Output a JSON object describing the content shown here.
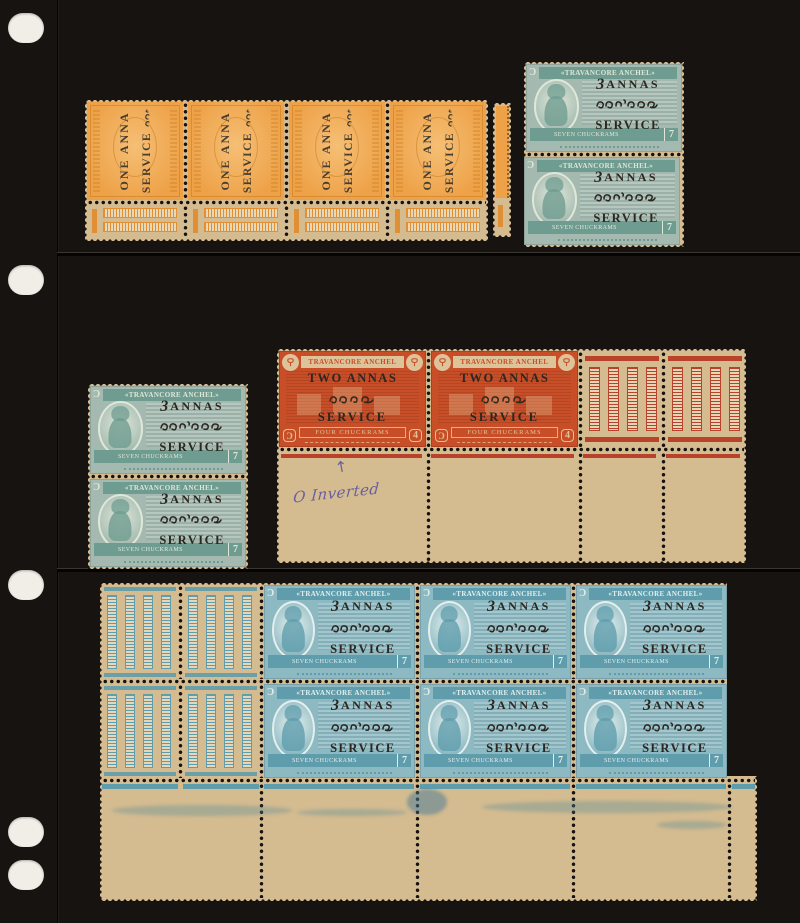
{
  "colors": {
    "page": "#161311",
    "tan": "#d4bb90",
    "orange": "#eea147",
    "orangeDeep": "#e08f34",
    "tealA": "#a4bab0",
    "tealADark": "#6f9c90",
    "tealB": "#8db9c2",
    "tealBDark": "#5f9dac",
    "red": "#c84e28",
    "overprint": "#2b2620",
    "ink": "#4c49a2",
    "punch": "#f1eee7"
  },
  "orange_stamp": {
    "overprint_value": "ONE ANNA",
    "overprint_service": "SERVICE",
    "overprint_malayalam": "ഒരണ"
  },
  "teal_stamp": {
    "corner_glyph": "Ɔ",
    "header": "«TRAVANCORE ANCHEL»",
    "overprint_numeral": "3",
    "overprint_value": "ANNAS",
    "overprint_malayalam": "മൂന്നണ",
    "overprint_service": "SERVICE",
    "denomination": "SEVEN CHUCKRAMS",
    "numeral": "7"
  },
  "red_stamp": {
    "corner_glyph": "Ɔ",
    "header": "TRAVANCORE ANCHEL",
    "overprint_value": "TWO ANNAS",
    "overprint_malayalam": "രണ്ടണ",
    "overprint_service": "SERVICE",
    "denomination": "FOUR CHUCKRAMS",
    "numeral": "4"
  },
  "annotation": {
    "arrow": "↑",
    "text": "O Inverted"
  },
  "blocks": {
    "orange_strip_count": 4,
    "top_right_pair_count": 2,
    "left_pair_count": 2,
    "red_pair_count": 2,
    "bottom_block_rows": 2,
    "bottom_block_cols": 3
  }
}
